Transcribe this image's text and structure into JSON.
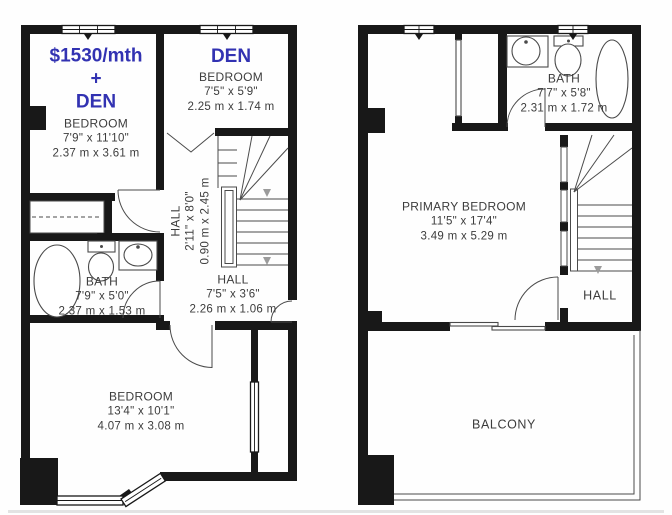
{
  "colors": {
    "wall": "#181818",
    "line": "#4a4a4a",
    "text": "#3c3c3c",
    "accent": "#3232b2"
  },
  "left_unit": {
    "price": {
      "line1": "$1530/mth",
      "line2": "+",
      "line3": "DEN"
    },
    "bedroom_top": {
      "name": "BEDROOM",
      "dim_ft": "7'9\" x 11'10\"",
      "dim_m": "2.37 m x 3.61 m"
    },
    "den": {
      "title": "DEN",
      "name": "BEDROOM",
      "dim_ft": "7'5\" x 5'9\"",
      "dim_m": "2.25 m x 1.74 m"
    },
    "hall_stairs": {
      "name": "HALL",
      "dim_ft": "2'11\" x 8'0\"",
      "dim_m": "0.90 m x 2.45 m"
    },
    "bath": {
      "name": "BATH",
      "dim_ft": "7'9\" x 5'0\"",
      "dim_m": "2.37 m x 1.53 m"
    },
    "hall": {
      "name": "HALL",
      "dim_ft": "7'5\" x 3'6\"",
      "dim_m": "2.26 m x 1.06 m"
    },
    "bedroom_bottom": {
      "name": "BEDROOM",
      "dim_ft": "13'4\" x 10'1\"",
      "dim_m": "4.07 m x 3.08 m"
    }
  },
  "right_unit": {
    "bath": {
      "name": "BATH",
      "dim_ft": "7'7\" x 5'8\"",
      "dim_m": "2.31 m x 1.72 m"
    },
    "primary_bedroom": {
      "name": "PRIMARY BEDROOM",
      "dim_ft": "11'5\" x 17'4\"",
      "dim_m": "3.49 m x 5.29 m"
    },
    "hall": {
      "name": "HALL"
    },
    "balcony": {
      "name": "BALCONY"
    }
  }
}
